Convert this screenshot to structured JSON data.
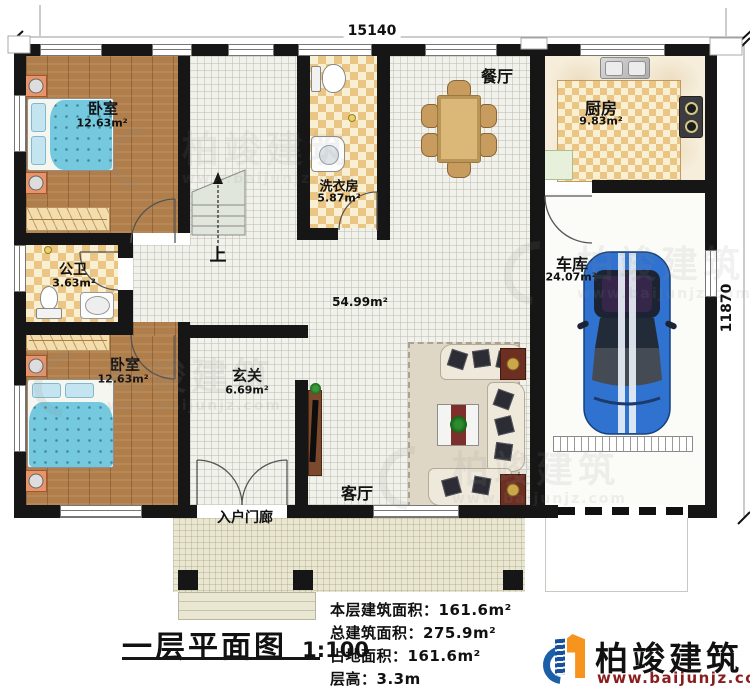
{
  "plan": {
    "drawing_type": "floor-plan",
    "dimensions": {
      "top": "15140",
      "right": "11870"
    },
    "rooms": {
      "bedroom1": {
        "name": "卧室",
        "area": "12.63m²"
      },
      "bathroom": {
        "name": "公卫",
        "area": "3.63m²"
      },
      "bedroom2": {
        "name": "卧室",
        "area": "12.63m²"
      },
      "laundry": {
        "name": "洗衣房",
        "area": "5.87m²"
      },
      "dining": {
        "name": "餐厅"
      },
      "kitchen": {
        "name": "厨房",
        "area": "9.83m²"
      },
      "garage": {
        "name": "车库",
        "area": "24.07m²"
      },
      "hall": {
        "name": "玄关",
        "area": "6.69m²"
      },
      "living": {
        "name": "客厅"
      },
      "porch": {
        "name": "入户门廊"
      },
      "open_area": {
        "area": "54.99m²"
      },
      "stairs": {
        "direction_label": "上"
      }
    }
  },
  "title_block": {
    "title": "一层平面图",
    "scale": "1:100",
    "stats": [
      {
        "label": "本层建筑面积：",
        "value": "161.6m²"
      },
      {
        "label": "总建筑面积：",
        "value": "275.9m²"
      },
      {
        "label": "占地面积：",
        "value": "161.6m²"
      },
      {
        "label": "层高：",
        "value": "3.3m"
      }
    ]
  },
  "brand": {
    "name": "柏竣建筑",
    "website": "www.baijunjz.com"
  },
  "watermark": {
    "name": "柏竣建筑",
    "website": "www.baijunjz.com"
  },
  "colors": {
    "wall": "#161616",
    "wood_floor": "#b07e4a",
    "checker_tan": "#eac584",
    "tile": "#f2f2ec",
    "bed_blue": "#74c9df",
    "car_blue": "#2f72cf",
    "brand_text": "#111111",
    "brand_url_red": "#8a1d1d",
    "brand_blue": "#1b5fa8",
    "brand_orange": "#f7941d"
  }
}
